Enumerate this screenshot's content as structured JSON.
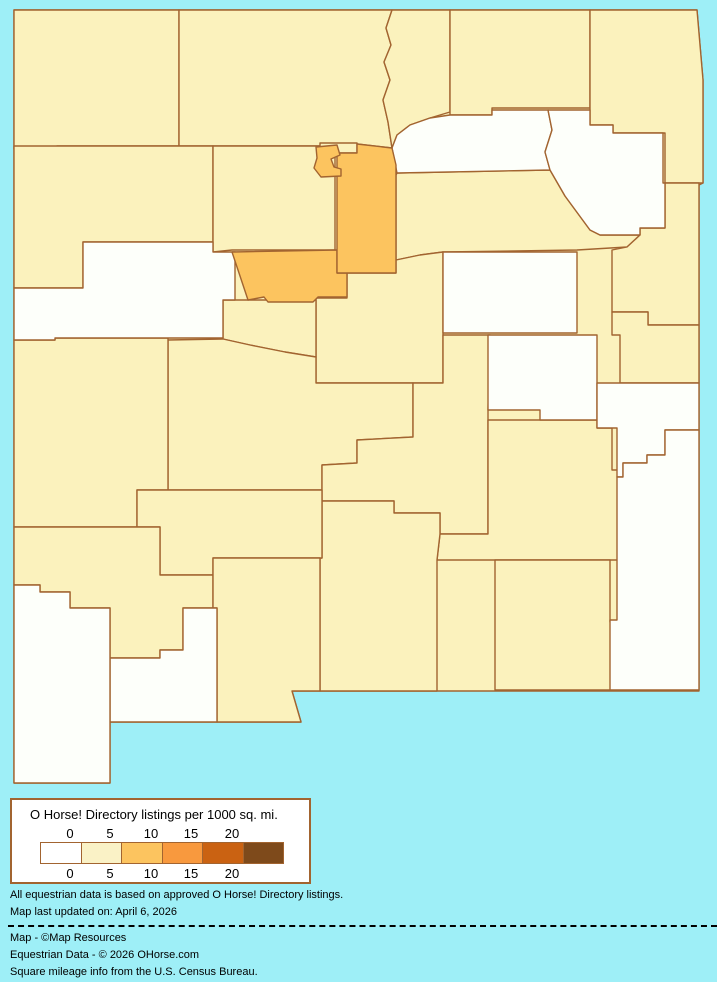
{
  "legend": {
    "title": "O Horse! Directory listings per 1000 sq. mi.",
    "ticks": [
      "0",
      "5",
      "10",
      "15",
      "20"
    ],
    "colors": [
      "#FFFFFF",
      "#FAF2C6",
      "#FCC45F",
      "#F8993E",
      "#CA6212",
      "#7E4A1B"
    ]
  },
  "map": {
    "background_color": "#9EEFF7",
    "border_color": "#A26430",
    "class_colors": {
      "c0": "#FDFFFA",
      "c1": "#FBF2BD",
      "c2": "#FCC45F"
    },
    "regions": [
      {
        "id": "san-juan",
        "class": "c1"
      },
      {
        "id": "rio-arriba",
        "class": "c1"
      },
      {
        "id": "taos",
        "class": "c1"
      },
      {
        "id": "colfax",
        "class": "c1"
      },
      {
        "id": "union",
        "class": "c1"
      },
      {
        "id": "mckinley",
        "class": "c1"
      },
      {
        "id": "sandoval",
        "class": "c1"
      },
      {
        "id": "san-miguel",
        "class": "c1"
      },
      {
        "id": "quay",
        "class": "c1"
      },
      {
        "id": "curry",
        "class": "c1"
      },
      {
        "id": "torrance",
        "class": "c1"
      },
      {
        "id": "valencia",
        "class": "c1"
      },
      {
        "id": "socorro",
        "class": "c1"
      },
      {
        "id": "catron",
        "class": "c1"
      },
      {
        "id": "lincoln",
        "class": "c1"
      },
      {
        "id": "chaves",
        "class": "c1"
      },
      {
        "id": "eddy",
        "class": "c1"
      },
      {
        "id": "otero",
        "class": "c1"
      },
      {
        "id": "sierra",
        "class": "c1"
      },
      {
        "id": "grant",
        "class": "c1"
      },
      {
        "id": "dona-ana",
        "class": "c1"
      },
      {
        "id": "mora",
        "class": "c0"
      },
      {
        "id": "harding",
        "class": "c0"
      },
      {
        "id": "cibola",
        "class": "c0"
      },
      {
        "id": "guadalupe",
        "class": "c0"
      },
      {
        "id": "de-baca",
        "class": "c0"
      },
      {
        "id": "roosevelt",
        "class": "c0"
      },
      {
        "id": "lea",
        "class": "c0"
      },
      {
        "id": "luna",
        "class": "c0"
      },
      {
        "id": "hidalgo",
        "class": "c0"
      },
      {
        "id": "los-alamos",
        "class": "c2"
      },
      {
        "id": "santa-fe",
        "class": "c2"
      },
      {
        "id": "bernalillo",
        "class": "c2"
      }
    ]
  },
  "footer": {
    "line1": "All equestrian data is based on approved O Horse! Directory listings.",
    "line2": "Map last updated on: April 6, 2026",
    "credit1": "Map - ©Map Resources",
    "credit2": "Equestrian Data - © 2026 OHorse.com",
    "credit3": "Square mileage info from the U.S. Census Bureau."
  }
}
